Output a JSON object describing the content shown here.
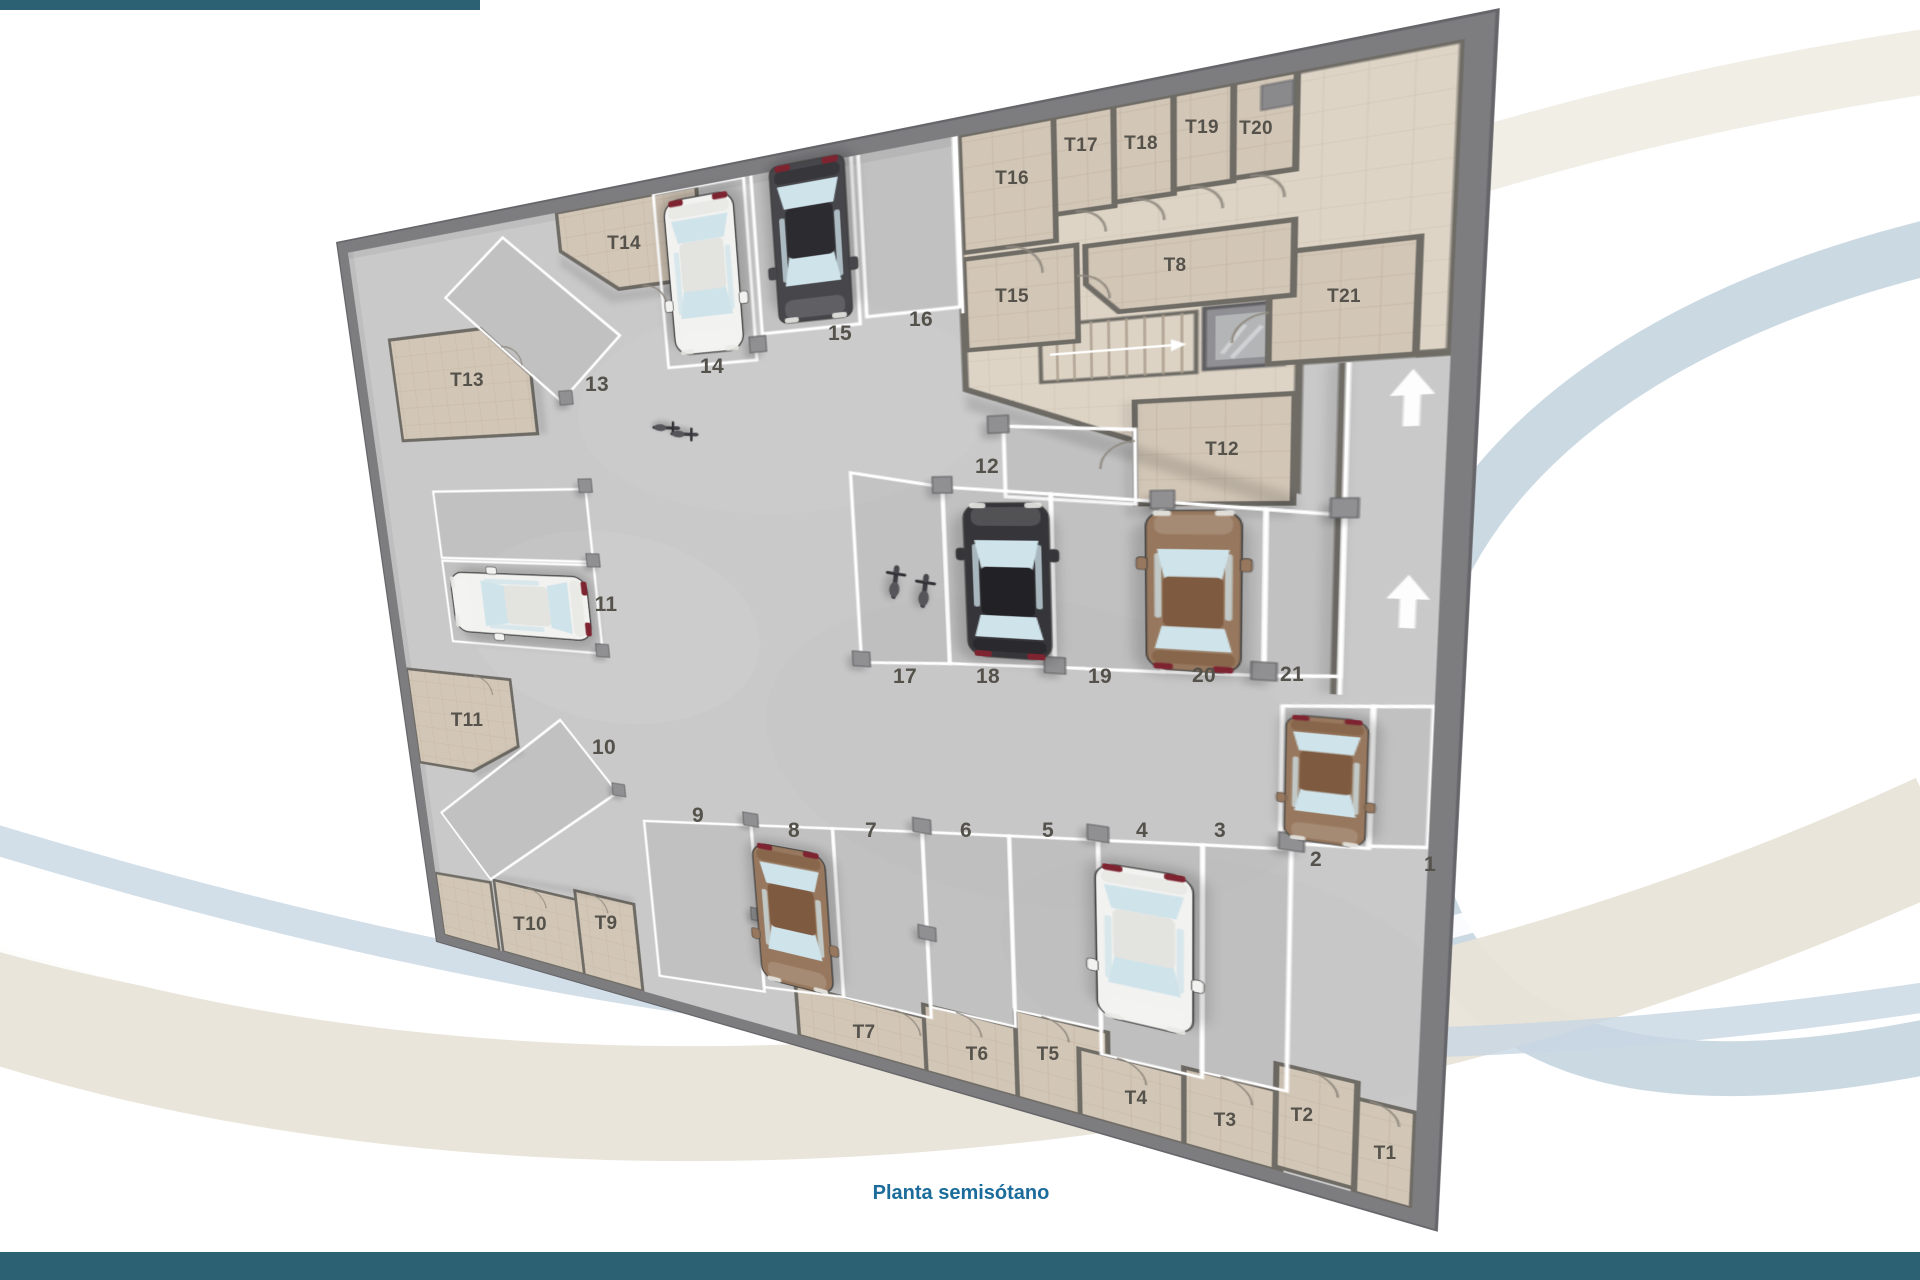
{
  "page": {
    "title": "Planta semisótano",
    "background_color": "#ffffff",
    "accent_bar_color": "#2c6173",
    "title_color": "#1b6c9b",
    "label_color": "#55524c"
  },
  "floor_plan": {
    "type": "parking-garage-floor-plan",
    "parking_spaces": [
      {
        "label": "1",
        "x": 1430,
        "y": 866
      },
      {
        "label": "2",
        "x": 1316,
        "y": 861
      },
      {
        "label": "3",
        "x": 1220,
        "y": 832
      },
      {
        "label": "4",
        "x": 1142,
        "y": 832
      },
      {
        "label": "5",
        "x": 1048,
        "y": 832
      },
      {
        "label": "6",
        "x": 966,
        "y": 832
      },
      {
        "label": "7",
        "x": 871,
        "y": 832
      },
      {
        "label": "8",
        "x": 794,
        "y": 832
      },
      {
        "label": "9",
        "x": 698,
        "y": 817
      },
      {
        "label": "10",
        "x": 604,
        "y": 749
      },
      {
        "label": "11",
        "x": 606,
        "y": 606
      },
      {
        "label": "12",
        "x": 987,
        "y": 468
      },
      {
        "label": "13",
        "x": 597,
        "y": 386
      },
      {
        "label": "14",
        "x": 712,
        "y": 368
      },
      {
        "label": "15",
        "x": 840,
        "y": 335
      },
      {
        "label": "16",
        "x": 921,
        "y": 321
      },
      {
        "label": "17",
        "x": 905,
        "y": 678
      },
      {
        "label": "18",
        "x": 988,
        "y": 678
      },
      {
        "label": "19",
        "x": 1100,
        "y": 678
      },
      {
        "label": "20",
        "x": 1204,
        "y": 677
      },
      {
        "label": "21",
        "x": 1292,
        "y": 676
      }
    ],
    "storage_rooms": [
      {
        "label": "T1",
        "x": 1385,
        "y": 1156
      },
      {
        "label": "T2",
        "x": 1302,
        "y": 1118
      },
      {
        "label": "T3",
        "x": 1225,
        "y": 1123
      },
      {
        "label": "T4",
        "x": 1136,
        "y": 1101
      },
      {
        "label": "T5",
        "x": 1048,
        "y": 1057
      },
      {
        "label": "T6",
        "x": 977,
        "y": 1057
      },
      {
        "label": "T7",
        "x": 864,
        "y": 1035
      },
      {
        "label": "T8",
        "x": 1175,
        "y": 268
      },
      {
        "label": "T9",
        "x": 606,
        "y": 926
      },
      {
        "label": "T10",
        "x": 530,
        "y": 927
      },
      {
        "label": "T11",
        "x": 467,
        "y": 723
      },
      {
        "label": "T12",
        "x": 1222,
        "y": 452
      },
      {
        "label": "T13",
        "x": 467,
        "y": 383
      },
      {
        "label": "T14",
        "x": 624,
        "y": 246
      },
      {
        "label": "T15",
        "x": 1012,
        "y": 299
      },
      {
        "label": "T16",
        "x": 1012,
        "y": 181
      },
      {
        "label": "T17",
        "x": 1081,
        "y": 148
      },
      {
        "label": "T18",
        "x": 1141,
        "y": 146
      },
      {
        "label": "T19",
        "x": 1202,
        "y": 130
      },
      {
        "label": "T20",
        "x": 1256,
        "y": 131
      },
      {
        "label": "T21",
        "x": 1344,
        "y": 299
      }
    ],
    "vehicles": [
      {
        "space": "15",
        "type": "suv",
        "color": "dark",
        "px": 555,
        "py": 88,
        "angle": 180,
        "scale": 1.0
      },
      {
        "space": "14",
        "type": "car",
        "color": "white",
        "px": 452,
        "py": 106,
        "angle": 180,
        "scale": 1.05
      },
      {
        "space": "11",
        "type": "car",
        "color": "white",
        "px": 196,
        "py": 477,
        "angle": -90,
        "scale": 1.22
      },
      {
        "space": "18",
        "type": "car",
        "color": "black",
        "px": 705,
        "py": 426,
        "angle": 0,
        "scale": 1.0
      },
      {
        "space": "20",
        "type": "car",
        "color": "brown",
        "px": 838,
        "py": 430,
        "angle": 0,
        "scale": 0.95
      },
      {
        "space": "8",
        "type": "car",
        "color": "brown",
        "px": 492,
        "py": 833,
        "angle": 180,
        "scale": 1.15
      },
      {
        "space": "4",
        "type": "car",
        "color": "white",
        "px": 803,
        "py": 783,
        "angle": 180,
        "scale": 1.08
      },
      {
        "space": "2",
        "type": "car",
        "color": "brown",
        "px": 923,
        "py": 592,
        "angle": 180,
        "scale": 0.75
      },
      {
        "space": "17",
        "type": "motorcycle",
        "color": "dark",
        "px": 612,
        "py": 432,
        "angle": 8,
        "scale": 1
      },
      {
        "space": "17",
        "type": "motorcycle",
        "color": "dark",
        "px": 637,
        "py": 440,
        "angle": 8,
        "scale": 1
      },
      {
        "space": "aisle",
        "type": "motorcycle",
        "color": "dark",
        "px": 398,
        "py": 263,
        "angle": 95,
        "scale": 0.85
      },
      {
        "space": "aisle",
        "type": "motorcycle",
        "color": "dark",
        "px": 417,
        "py": 271,
        "angle": 95,
        "scale": 0.85
      }
    ],
    "ramp_arrows": [
      {
        "px": 965,
        "py": 270
      },
      {
        "px": 967,
        "py": 432
      }
    ]
  }
}
